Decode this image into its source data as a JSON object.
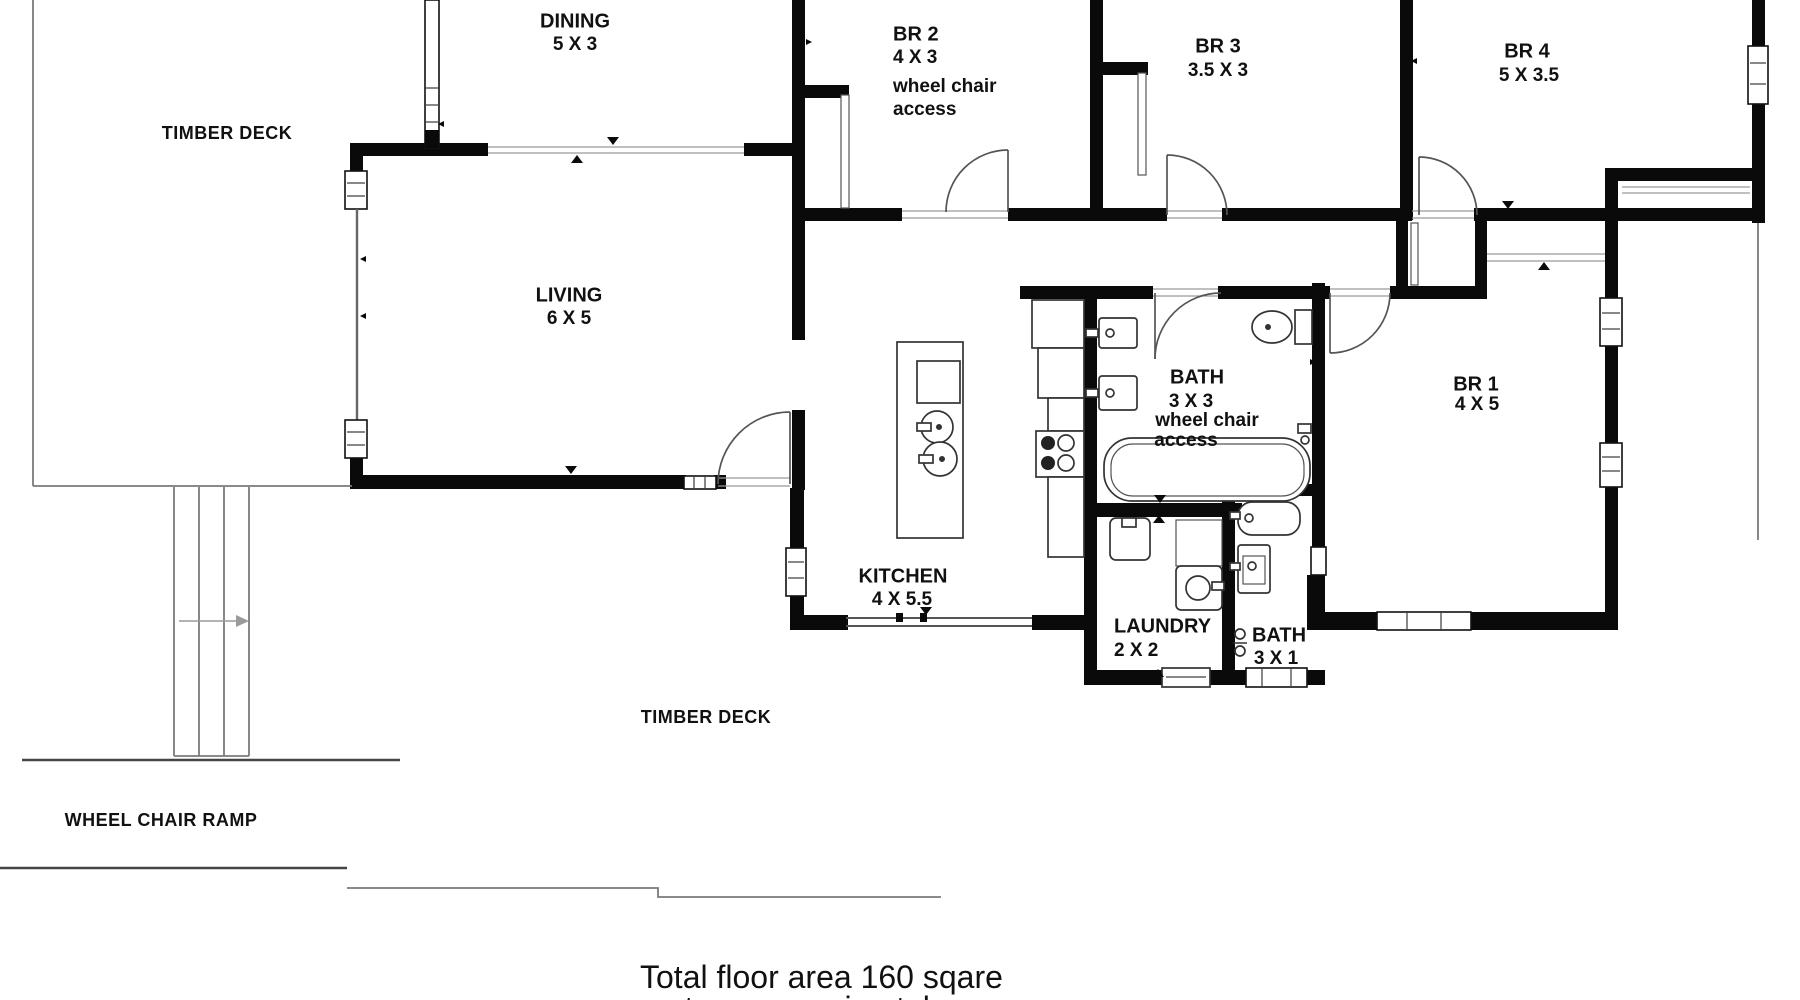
{
  "rooms": {
    "dining": {
      "name": "DINING",
      "dims": "5 X 3"
    },
    "living": {
      "name": "LIVING",
      "dims": "6 X 5"
    },
    "kitchen": {
      "name": "KITCHEN",
      "dims": "4 X 5.5"
    },
    "br1": {
      "name": "BR 1",
      "dims": "4 X 5"
    },
    "br2": {
      "name": "BR 2",
      "dims": "4 X 3",
      "note_line1": "wheel chair",
      "note_line2": "access"
    },
    "br3": {
      "name": "BR 3",
      "dims": "3.5 X 3"
    },
    "br4": {
      "name": "BR 4",
      "dims": "5 X 3.5"
    },
    "bath_main": {
      "name": "BATH",
      "dims": "3 X 3",
      "note_line1": "wheel chair",
      "note_line2": "access"
    },
    "bath_small": {
      "name": "BATH",
      "dims": "3 X 1"
    },
    "laundry": {
      "name": "LAUNDRY",
      "dims": "2 X 2"
    }
  },
  "outdoor": {
    "deck_top_label": "TIMBER DECK",
    "deck_bottom_label": "TIMBER DECK",
    "ramp_label": "WHEEL CHAIR RAMP"
  },
  "footer": {
    "line1": "Total floor area 160 sqare",
    "line2": "metres approximately"
  },
  "colors": {
    "wall": "#0a0a0a",
    "text": "#111111",
    "fixture_line": "#333333",
    "deck_line": "#7a7a7a"
  }
}
